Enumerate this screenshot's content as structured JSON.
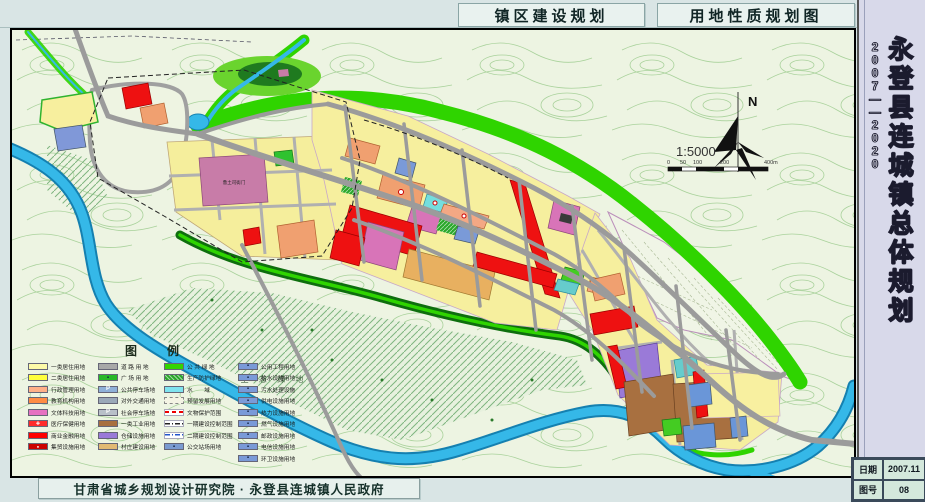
{
  "header": {
    "title_left": "镇区建设规划",
    "title_right": "用地性质规划图"
  },
  "sidebar": {
    "title": "永登县连城镇总体规划",
    "years": "2007——2020",
    "info_rows": [
      {
        "label": "日期",
        "value": "2007.11"
      },
      {
        "label": "图号",
        "value": "08"
      }
    ]
  },
  "footer": {
    "attribution": "甘肃省城乡规划设计研究院 · 永登县连城镇人民政府"
  },
  "map": {
    "labels": {
      "north": "N",
      "scale": "1:5000",
      "scale_ticks": [
        "0",
        "50",
        "100",
        "200",
        "400m"
      ],
      "eco_green": "生 态 绿 地",
      "historic_site": "鲁土司衙门"
    },
    "colors": {
      "water": "#35b8e8",
      "public_green": "#2fd400",
      "protective_green": "#0e6e0e",
      "residential": "#f6ef9e",
      "commercial": "#ee1111",
      "culture": "#d874b8",
      "education": "#f0a070",
      "industry": "#a87040",
      "warehouse": "#9a7ad8",
      "road": "#9b9b9b"
    }
  },
  "legend": {
    "title": "图　　例",
    "columns": [
      {
        "items": [
          {
            "label": "一类居住用地",
            "color": "#fdfaa8",
            "kind": "fill"
          },
          {
            "label": "二类居住用地",
            "color": "#ffff3c",
            "kind": "fill"
          },
          {
            "label": "行政管理用地",
            "color": "#ffb088",
            "kind": "fill"
          },
          {
            "label": "教育机构用地",
            "color": "#ff8c45",
            "kind": "fill"
          },
          {
            "label": "文体科技用地",
            "color": "#e671c1",
            "kind": "fill"
          },
          {
            "label": "医疗保健用地",
            "color": "#ff2a2a",
            "kind": "cross"
          },
          {
            "label": "商业金融用地",
            "color": "#ff0000",
            "kind": "fill"
          },
          {
            "label": "集贸设施用地",
            "color": "#cc0000",
            "kind": "dot"
          }
        ]
      },
      {
        "items": [
          {
            "label": "道 路 用 地",
            "color": "#a8a8a8",
            "kind": "fill"
          },
          {
            "label": "广 场 用 地",
            "color": "#28b828",
            "kind": "icon"
          },
          {
            "label": "公共停车场地",
            "color": "#8fb0d8",
            "kind": "p"
          },
          {
            "label": "对外交通用地",
            "color": "#9aa8b8",
            "kind": "fill"
          },
          {
            "label": "社会停车场地",
            "color": "#b8c0c8",
            "kind": "p"
          },
          {
            "label": "一类工业用地",
            "color": "#a87040",
            "kind": "fill"
          },
          {
            "label": "仓储设施用地",
            "color": "#9a7ad8",
            "kind": "fill"
          },
          {
            "label": "村庄建设用地",
            "color": "#e2ba74",
            "kind": "fill"
          }
        ]
      },
      {
        "items": [
          {
            "label": "公 共 绿 地",
            "color": "#33d400",
            "kind": "fill"
          },
          {
            "label": "生产防护绿地",
            "color": "#2aa62a",
            "kind": "hatch"
          },
          {
            "label": "水　　域",
            "color": "#7fe3ef",
            "kind": "fill"
          },
          {
            "label": "预留发展用地",
            "color": "#f4f4e4",
            "kind": "dashed-border"
          },
          {
            "label": "文物保护范围",
            "color": "#ffffff",
            "kind": "dashes-red"
          },
          {
            "label": "一期建设控制范围",
            "color": "#ffffff",
            "kind": "dashdot-black"
          },
          {
            "label": "二期建设控制范围",
            "color": "#ffffff",
            "kind": "dashdot-blue"
          },
          {
            "label": "公交站场用地",
            "color": "#7a9ad0",
            "kind": "icon"
          }
        ]
      },
      {
        "items": [
          {
            "label": "公用工程用地",
            "color": "#7a9ad8",
            "kind": "icon"
          },
          {
            "label": "给水设施用地",
            "color": "#7a9ad8",
            "kind": "icon"
          },
          {
            "label": "污水处理设施",
            "color": "#7a9ad8",
            "kind": "icon"
          },
          {
            "label": "供电设施用地",
            "color": "#7a9ad8",
            "kind": "icon"
          },
          {
            "label": "热力设施用地",
            "color": "#7a9ad8",
            "kind": "icon"
          },
          {
            "label": "燃气设施用地",
            "color": "#7a9ad8",
            "kind": "icon"
          },
          {
            "label": "邮政设施用地",
            "color": "#7a9ad8",
            "kind": "icon"
          },
          {
            "label": "电信设施用地",
            "color": "#7a9ad8",
            "kind": "icon"
          },
          {
            "label": "环卫设施用地",
            "color": "#7a9ad8",
            "kind": "icon"
          }
        ]
      }
    ]
  }
}
